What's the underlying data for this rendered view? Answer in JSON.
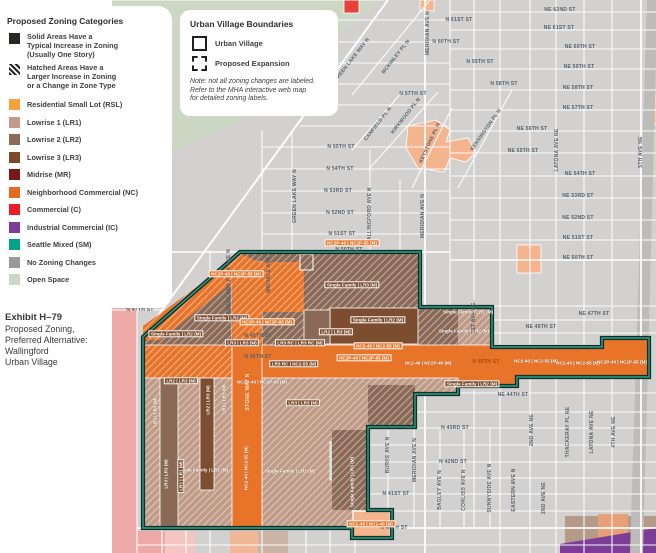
{
  "zoning_legend": {
    "title": "Proposed Zoning Categories",
    "explainers": [
      {
        "swatch": "solid",
        "color": "#2b2624",
        "lines": [
          "Solid Areas Have a",
          "Typical Increase in Zoning",
          "(Usually One Story)"
        ]
      },
      {
        "swatch": "hatched",
        "color": "#2b2624",
        "lines": [
          "Hatched Areas Have a",
          "Larger Increase in Zoning",
          "or a Change in Zone Type"
        ]
      }
    ],
    "items": [
      {
        "label": "Residential Small Lot (RSL)",
        "color": "#f6a33c"
      },
      {
        "label": "Lowrise 1 (LR1)",
        "color": "#c39b88"
      },
      {
        "label": "Lowrise 2 (LR2)",
        "color": "#8a6a56"
      },
      {
        "label": "Lowrise 3 (LR3)",
        "color": "#7c4a2a"
      },
      {
        "label": "Midrise (MR)",
        "color": "#7a171a"
      },
      {
        "label": "Neighborhood Commercial (NC)",
        "color": "#e56a22"
      },
      {
        "label": "Commercial (C)",
        "color": "#ec1c24"
      },
      {
        "label": "Industrial Commercial (IC)",
        "color": "#7b3d96"
      },
      {
        "label": "Seattle Mixed (SM)",
        "color": "#00a28a"
      },
      {
        "label": "No Zoning Changes",
        "color": "#9a9a9a"
      },
      {
        "label": "Open Space",
        "color": "#ccd7c4"
      }
    ]
  },
  "boundary_legend": {
    "title": "Urban Village Boundaries",
    "items": [
      {
        "label": "Urban Village",
        "swatch": "solid-outline"
      },
      {
        "label": "Proposed Expansion",
        "swatch": "dashed-outline"
      }
    ],
    "note_lines": [
      "Note: not all zoning changes are labeled.",
      "Refer to the MHA interactive web map",
      "for detailed zoning labels."
    ]
  },
  "exhibit": {
    "title": "Exhibit H–79",
    "lines": [
      "Proposed Zoning,",
      "Preferred Alternative:",
      "Wallingford",
      "Urban Village"
    ]
  },
  "map": {
    "colors": {
      "background": "#d2d1cf",
      "street_line": "#ffffff",
      "boundary_dark": "#142f28",
      "boundary_teal": "#2aa189",
      "nc_orange": "#e8742a",
      "lr1": "#c09b87",
      "lr2": "#8a6a56",
      "lr3": "#7c4d2e",
      "rsl_salmon": "#f3b48e",
      "pink": "#eda9a5",
      "open_space": "#ccd7c4",
      "purple": "#7b3d96"
    },
    "streets": [
      {
        "t": "GREEN LAKE WAY N",
        "x": 352,
        "y": 60,
        "r": -52
      },
      {
        "t": "MCKINLEY PL N",
        "x": 396,
        "y": 57,
        "r": -52
      },
      {
        "t": "MERIDIAN AVE N",
        "x": 428,
        "y": 33,
        "r": -90
      },
      {
        "t": "N 61ST ST",
        "x": 459,
        "y": 20,
        "r": 0
      },
      {
        "t": "N 60TH ST",
        "x": 446,
        "y": 42,
        "r": 0
      },
      {
        "t": "N 59TH ST",
        "x": 480,
        "y": 62,
        "r": 0
      },
      {
        "t": "N 58TH ST",
        "x": 504,
        "y": 84,
        "r": 0
      },
      {
        "t": "N 57TH ST",
        "x": 413,
        "y": 94,
        "r": 0
      },
      {
        "t": "CANFIELD PL N",
        "x": 378,
        "y": 124,
        "r": -52
      },
      {
        "t": "KIRKWOOD PL N",
        "x": 406,
        "y": 116,
        "r": -52
      },
      {
        "t": "KEYSTONE PL N",
        "x": 430,
        "y": 143,
        "r": -65
      },
      {
        "t": "KENSINGTON PL N",
        "x": 486,
        "y": 130,
        "r": -55
      },
      {
        "t": "GREEN LAKE WAY N",
        "x": 295,
        "y": 196,
        "r": -90
      },
      {
        "t": "WALLINGFORD AVE N",
        "x": 370,
        "y": 216,
        "r": -90
      },
      {
        "t": "MERIDIAN AVE N",
        "x": 423,
        "y": 216,
        "r": -90
      },
      {
        "t": "N 55TH ST",
        "x": 341,
        "y": 147,
        "r": 0
      },
      {
        "t": "N 54TH ST",
        "x": 340,
        "y": 169,
        "r": 0
      },
      {
        "t": "N 53RD ST",
        "x": 338,
        "y": 191,
        "r": 0
      },
      {
        "t": "N 52ND ST",
        "x": 340,
        "y": 213,
        "r": 0
      },
      {
        "t": "N 51ST ST",
        "x": 342,
        "y": 234,
        "r": 0
      },
      {
        "t": "N 50TH ST",
        "x": 349,
        "y": 250,
        "r": 0
      },
      {
        "t": "N 47TH ST",
        "x": 140,
        "y": 310,
        "r": 0
      },
      {
        "t": "NE 62ND ST",
        "x": 560,
        "y": 10,
        "r": 0
      },
      {
        "t": "NE 61ST ST",
        "x": 559,
        "y": 28,
        "r": 0
      },
      {
        "t": "NE 60TH ST",
        "x": 580,
        "y": 47,
        "r": 0
      },
      {
        "t": "NE 59TH ST",
        "x": 579,
        "y": 67,
        "r": 0
      },
      {
        "t": "NE 58TH ST",
        "x": 578,
        "y": 88,
        "r": 0
      },
      {
        "t": "NE 57TH ST",
        "x": 578,
        "y": 108,
        "r": 0
      },
      {
        "t": "NE 56TH ST",
        "x": 532,
        "y": 129,
        "r": 0
      },
      {
        "t": "NE 55TH ST",
        "x": 523,
        "y": 151,
        "r": 0
      },
      {
        "t": "NE 54TH ST",
        "x": 580,
        "y": 174,
        "r": 0
      },
      {
        "t": "NE 53RD ST",
        "x": 578,
        "y": 196,
        "r": 0
      },
      {
        "t": "NE 52ND ST",
        "x": 578,
        "y": 218,
        "r": 0
      },
      {
        "t": "NE 51ST ST",
        "x": 578,
        "y": 238,
        "r": 0
      },
      {
        "t": "NE 50TH ST",
        "x": 578,
        "y": 258,
        "r": 0
      },
      {
        "t": "LATONA AVE NE",
        "x": 557,
        "y": 150,
        "r": -90
      },
      {
        "t": "5TH AVE NE",
        "x": 641,
        "y": 152,
        "r": -90
      },
      {
        "t": "NE 47TH ST",
        "x": 594,
        "y": 314,
        "r": 0
      },
      {
        "t": "NE 46TH ST",
        "x": 541,
        "y": 327,
        "r": 0
      },
      {
        "t": "1ST AVE NE",
        "x": 474,
        "y": 318,
        "r": -90
      },
      {
        "t": "NE 44TH ST",
        "x": 513,
        "y": 395,
        "r": 0
      },
      {
        "t": "N 43RD ST",
        "x": 455,
        "y": 428,
        "r": 0
      },
      {
        "t": "N 42ND ST",
        "x": 453,
        "y": 462,
        "r": 0
      },
      {
        "t": "N 41ST ST",
        "x": 396,
        "y": 494,
        "r": 0
      },
      {
        "t": "N 40TH ST",
        "x": 394,
        "y": 528,
        "r": 0
      },
      {
        "t": "BURKE AVE N",
        "x": 388,
        "y": 455,
        "r": -90
      },
      {
        "t": "MERIDIAN AVE N",
        "x": 415,
        "y": 460,
        "r": -90
      },
      {
        "t": "BAGLEY AVE N",
        "x": 440,
        "y": 490,
        "r": -90
      },
      {
        "t": "CORLISS AVE N",
        "x": 464,
        "y": 490,
        "r": -90
      },
      {
        "t": "SUNNYSIDE AVE N",
        "x": 490,
        "y": 488,
        "r": -90
      },
      {
        "t": "EASTERN AVE N",
        "x": 514,
        "y": 490,
        "r": -90
      },
      {
        "t": "2ND AVE NE",
        "x": 544,
        "y": 498,
        "r": -90
      },
      {
        "t": "2ND AVE NE",
        "x": 532,
        "y": 430,
        "r": -90
      },
      {
        "t": "THACKERAY PL NE",
        "x": 568,
        "y": 432,
        "r": -90
      },
      {
        "t": "LATONA AVE NE",
        "x": 592,
        "y": 432,
        "r": -90
      },
      {
        "t": "4TH AVE NE",
        "x": 614,
        "y": 432,
        "r": -90
      },
      {
        "t": "WOODLAND PARK AVE N",
        "x": 229,
        "y": 282,
        "r": -90
      },
      {
        "t": "MIDVALE AVE N",
        "x": 269,
        "y": 272,
        "r": -90
      },
      {
        "t": "STONE WAY N",
        "x": 248,
        "y": 392,
        "r": -90,
        "v": "on-orange"
      },
      {
        "t": "N 46TH ST",
        "x": 258,
        "y": 336,
        "r": 0
      },
      {
        "t": "N 45TH ST",
        "x": 258,
        "y": 357,
        "r": 0
      },
      {
        "t": "N 45TH ST",
        "x": 486,
        "y": 362,
        "r": 0,
        "v": "on-orange-dark"
      }
    ],
    "zone_labels": [
      {
        "t": "NC2P-40 | NC2P-55 (M)",
        "x": 352,
        "y": 243,
        "r": 0,
        "s": "chip-orange"
      },
      {
        "t": "NC2P-40 | NC2P-55 (M)",
        "x": 236,
        "y": 274,
        "r": 0,
        "s": "chip-orange"
      },
      {
        "t": "Single Family | LR2 (M)",
        "x": 222,
        "y": 318,
        "r": 0,
        "s": "chip-brown"
      },
      {
        "t": "Single Family | LR2 (M)",
        "x": 176,
        "y": 334,
        "r": 0,
        "s": "chip-brown"
      },
      {
        "t": "Single Family | LR3 (M)",
        "x": 352,
        "y": 285,
        "r": 0,
        "s": "chip-brown"
      },
      {
        "t": "Single Family | LR2 (M)",
        "x": 378,
        "y": 320,
        "r": 0,
        "s": "chip-brown"
      },
      {
        "t": "LR2 | LR3 (M)",
        "x": 336,
        "y": 332,
        "r": 0,
        "s": "chip-brown"
      },
      {
        "t": "NC2-40 | NC2-55 (M)",
        "x": 378,
        "y": 346,
        "r": 0,
        "s": "chip-orange"
      },
      {
        "t": "NC2P-40 | NC2P-55 (M)",
        "x": 364,
        "y": 358,
        "r": 0,
        "s": "chip-orange"
      },
      {
        "t": "NC2-40 | NC2P-40 (M)",
        "x": 428,
        "y": 363,
        "r": 0,
        "s": "text-white"
      },
      {
        "t": "Single Family | LR1 (M)",
        "x": 468,
        "y": 312,
        "r": 0,
        "s": "text-white"
      },
      {
        "t": "Single Family | LR2 (M)",
        "x": 464,
        "y": 331,
        "r": 0,
        "s": "text-white"
      },
      {
        "t": "NC2P-40 | NC2P-65 (M)",
        "x": 267,
        "y": 322,
        "r": 0,
        "s": "chip-orange"
      },
      {
        "t": "LR3 RC | LR3 RC (M)",
        "x": 300,
        "y": 343,
        "r": 0,
        "s": "chip-brown"
      },
      {
        "t": "LR3 RC | NC2-55 (M)",
        "x": 294,
        "y": 364,
        "r": 0,
        "s": "chip-brown"
      },
      {
        "t": "LR3 | LR3 (M)",
        "x": 242,
        "y": 343,
        "r": 0,
        "s": "chip-brown"
      },
      {
        "t": "NC2P-40 | NC2P-65 (M)",
        "x": 262,
        "y": 382,
        "r": 0,
        "s": "text-white"
      },
      {
        "t": "LR2 | LR3 (M)",
        "x": 181,
        "y": 381,
        "r": 0,
        "s": "chip-brown"
      },
      {
        "t": "LR3 | LR3 (M)",
        "x": 303,
        "y": 403,
        "r": 0,
        "s": "chip-brown"
      },
      {
        "t": "Single Family | LR1 (M)",
        "x": 203,
        "y": 470,
        "r": 0,
        "s": "text-white"
      },
      {
        "t": "Single Family | LR1 (M)",
        "x": 290,
        "y": 471,
        "r": 0,
        "s": "text-white"
      },
      {
        "t": "NC2-40 | NC2-55 (M)",
        "x": 246,
        "y": 468,
        "r": -90,
        "s": "text-white"
      },
      {
        "t": "LR2 | LR3 (M)",
        "x": 155,
        "y": 412,
        "r": -90,
        "s": "text-white"
      },
      {
        "t": "LR3 | LR3 (M)",
        "x": 166,
        "y": 474,
        "r": -90,
        "s": "text-white"
      },
      {
        "t": "LR2 | LR3 (M)",
        "x": 208,
        "y": 400,
        "r": -90,
        "s": "text-white"
      },
      {
        "t": "LR2 | LR3 (M)",
        "x": 224,
        "y": 399,
        "r": -90,
        "s": "text-white"
      },
      {
        "t": "LR1 | LR1 (M)",
        "x": 181,
        "y": 476,
        "r": -90,
        "s": "chip-brown"
      },
      {
        "t": "Single Family | LR3 (M)",
        "x": 352,
        "y": 482,
        "r": -90,
        "s": "text-white"
      },
      {
        "t": "Single Family | LR2 (M)",
        "x": 472,
        "y": 384,
        "r": 0,
        "s": "chip-brown"
      },
      {
        "t": "NC2-40 | NC2-55 (M)",
        "x": 536,
        "y": 361,
        "r": 0,
        "s": "text-white"
      },
      {
        "t": "NC2-40 | NC2-55 (M)",
        "x": 578,
        "y": 363,
        "r": 0,
        "s": "text-white"
      },
      {
        "t": "NC2P-40 | NC2P-65 (M)",
        "x": 622,
        "y": 362,
        "r": 0,
        "s": "text-white"
      },
      {
        "t": "NC1-40 | NC1-40 (M)",
        "x": 371,
        "y": 524,
        "r": 0,
        "s": "chip-orange"
      }
    ]
  }
}
